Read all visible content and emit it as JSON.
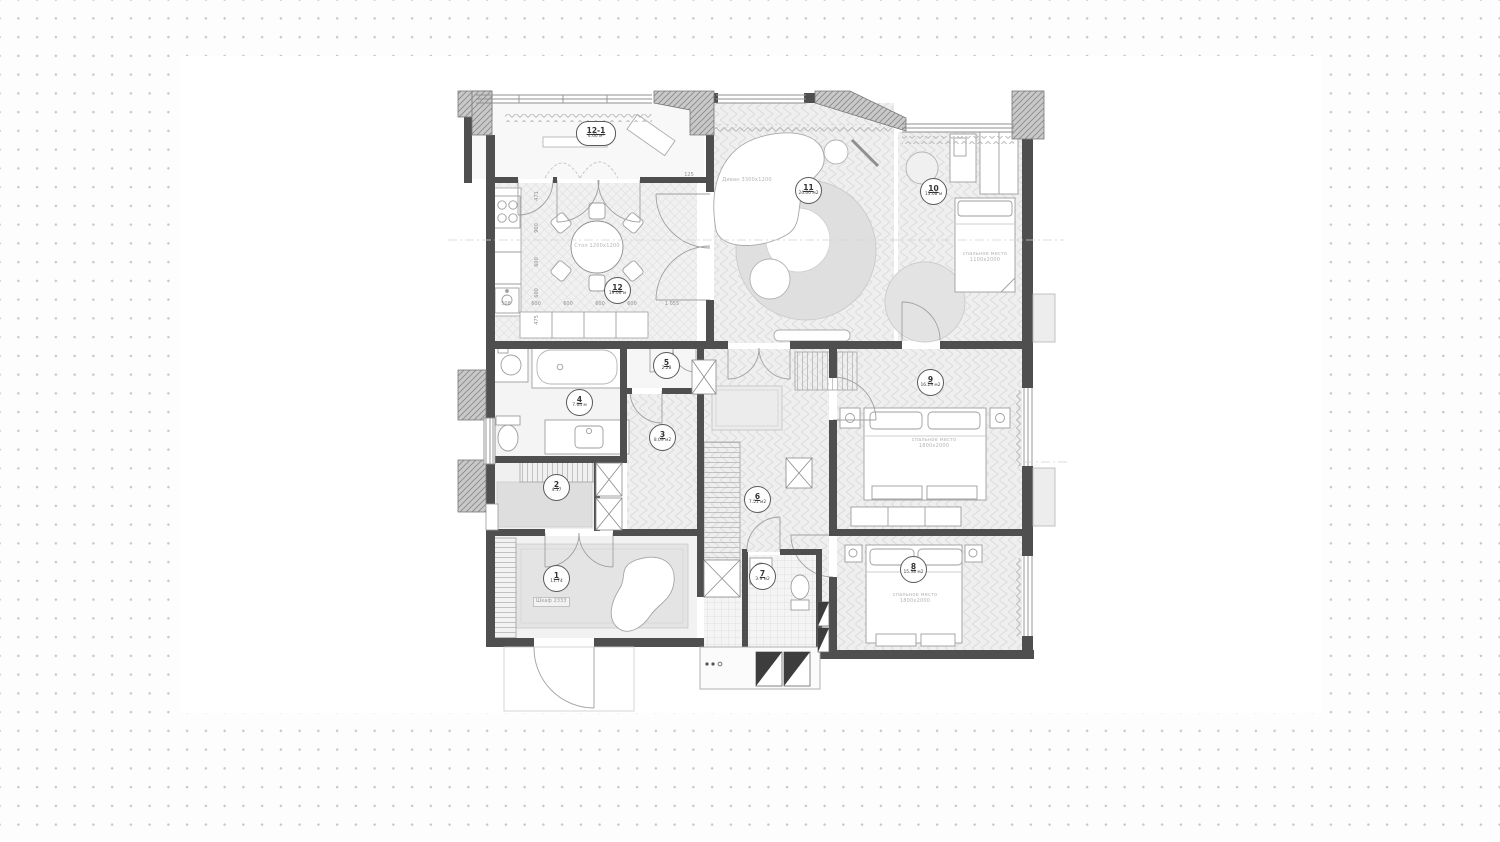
{
  "background": {
    "dot_color": "#c6c6c6",
    "paper_color": "#ffffff"
  },
  "rooms": [
    {
      "number": "1",
      "area": "11.74"
    },
    {
      "number": "2",
      "area": "4.17"
    },
    {
      "number": "3",
      "area": "8.09 м2"
    },
    {
      "number": "4",
      "area": "7.04 м"
    },
    {
      "number": "5",
      "area": "2.28"
    },
    {
      "number": "6",
      "area": "7.51 м2"
    },
    {
      "number": "7",
      "area": "3.9 м2"
    },
    {
      "number": "8",
      "area": "15.38 м2"
    },
    {
      "number": "9",
      "area": "16.29 м2"
    },
    {
      "number": "10",
      "area": "13.08 м"
    },
    {
      "number": "11",
      "area": "24.00 м2"
    },
    {
      "number": "12",
      "area": "19.06 м"
    },
    {
      "number": "12-1",
      "area": "4.66 м²"
    }
  ],
  "furniture": {
    "sofa": "Диван 3300x1200",
    "table": "Стол 1200x1200",
    "wardrobe": "Шкаф 2333",
    "bed_single": {
      "line1": "спальное место",
      "line2": "1100x2000"
    },
    "bed_master": {
      "line1": "спальное место",
      "line2": "1800x2000"
    },
    "bed_second": {
      "line1": "спальное место",
      "line2": "1800x2000"
    }
  },
  "dimensions": {
    "kitchen_left": [
      "471",
      "900",
      "600",
      "600",
      "475"
    ],
    "kitchen_bottom": [
      "508",
      "600",
      "600",
      "600",
      "600",
      "1 055"
    ],
    "door": "125"
  }
}
